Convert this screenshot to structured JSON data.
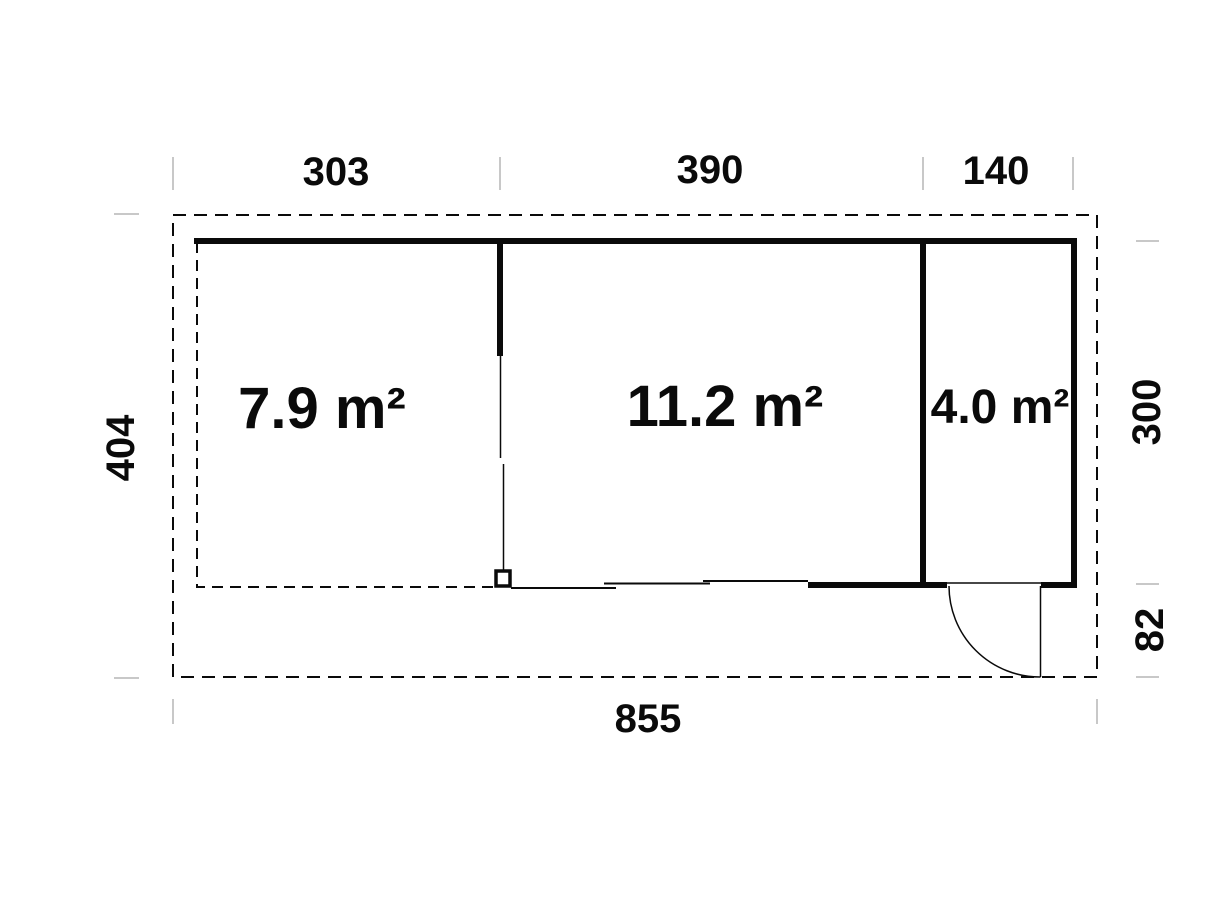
{
  "floor_plan": {
    "rooms": [
      {
        "name": "left-room",
        "area": "7.9 m²"
      },
      {
        "name": "middle-room",
        "area": "11.2 m²"
      },
      {
        "name": "right-room",
        "area": "4.0 m²"
      }
    ],
    "dimensions": {
      "top": [
        "303",
        "390",
        "140"
      ],
      "left": [
        "404"
      ],
      "right": [
        "300",
        "82"
      ],
      "bottom": [
        "855"
      ]
    },
    "colors": {
      "line": "#0a0a0a",
      "tick": "#c8c8c8",
      "background": "#ffffff"
    }
  }
}
